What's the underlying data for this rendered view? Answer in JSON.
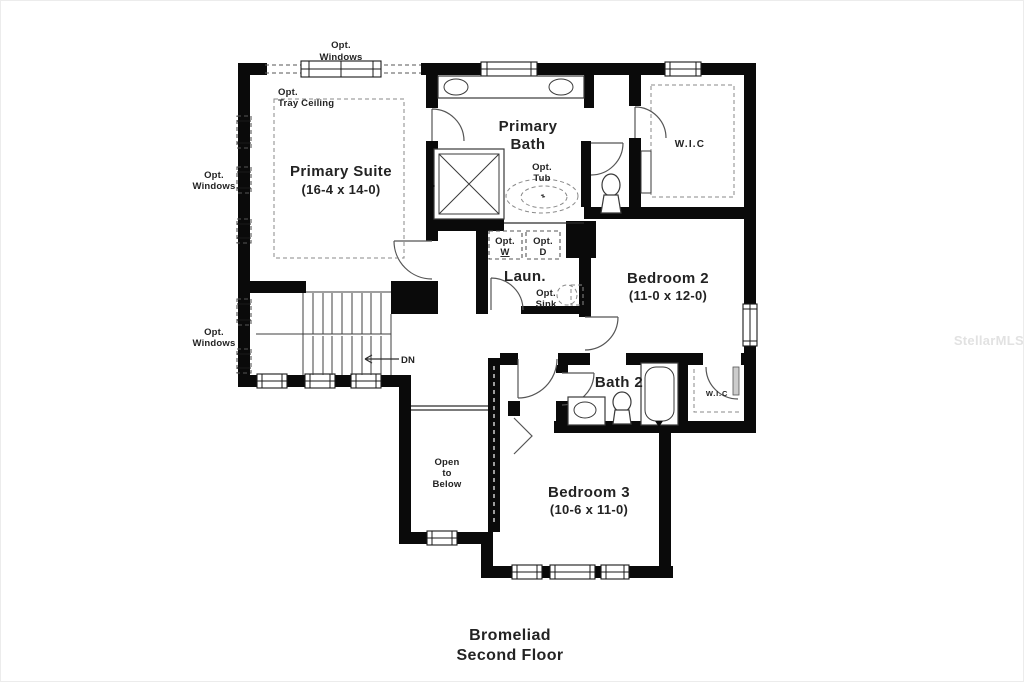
{
  "page": {
    "background": "#ffffff",
    "wall_color": "#0a0a0a",
    "text_color": "#232323",
    "dashed_color": "#555555",
    "watermark_color": "#e2e2e2"
  },
  "title": {
    "line1": "Bromeliad",
    "line2": "Second Floor"
  },
  "watermark": "StellarMLS",
  "rooms": {
    "primary_suite": {
      "name": "Primary Suite",
      "dims": "(16-4 x 14-0)"
    },
    "primary_bath": {
      "line1": "Primary",
      "line2": "Bath"
    },
    "wic_primary": {
      "name": "W.I.C"
    },
    "bedroom2": {
      "name": "Bedroom 2",
      "dims": "(11-0 x 12-0)"
    },
    "laundry": {
      "name": "Laun."
    },
    "bath2": {
      "name": "Bath 2"
    },
    "wic2": {
      "name": "W.I.C"
    },
    "bedroom3": {
      "name": "Bedroom 3",
      "dims": "(10-6 x 11-0)"
    },
    "open_below": {
      "line1": "Open",
      "line2": "to",
      "line3": "Below"
    }
  },
  "annotations": {
    "opt_windows_top": {
      "line1": "Opt.",
      "line2": "Windows"
    },
    "opt_windows_left_upper": {
      "line1": "Opt.",
      "line2": "Windows"
    },
    "opt_windows_left_lower": {
      "line1": "Opt.",
      "line2": "Windows"
    },
    "opt_tray_ceiling": {
      "line1": "Opt.",
      "line2": "Tray Ceiling"
    },
    "opt_tub": {
      "line1": "Opt.",
      "line2": "Tub"
    },
    "opt_washer": {
      "line1": "Opt.",
      "line2": "W"
    },
    "opt_dryer": {
      "line1": "Opt.",
      "line2": "D"
    },
    "opt_sink": {
      "line1": "Opt.",
      "line2": "Sink"
    },
    "stairs_down": "DN"
  }
}
